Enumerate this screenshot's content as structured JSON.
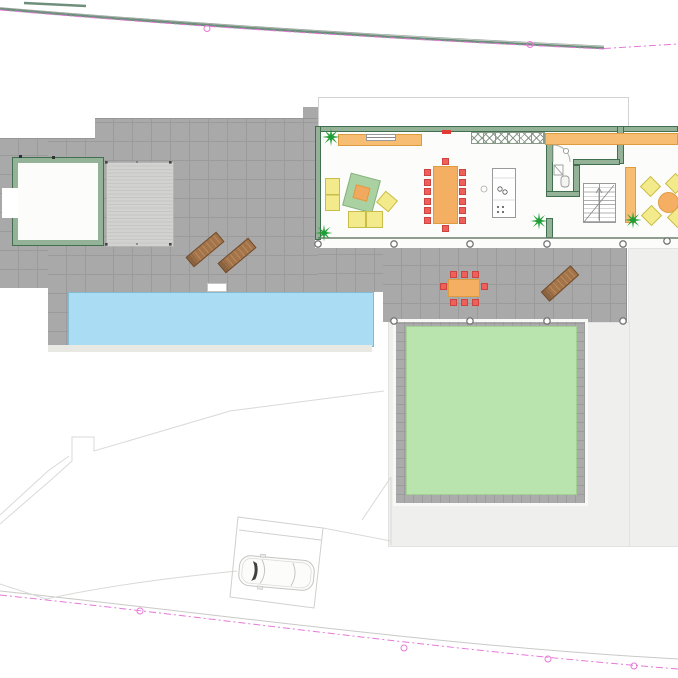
{
  "drawing": {
    "type": "architectural-site-plan",
    "visible_text": [],
    "elements": [
      "property-boundary-north",
      "property-boundary-south",
      "swimming-pool",
      "pool-ladder",
      "stone-terrace",
      "pool-house",
      "wood-deck",
      "residence",
      "roof-outline",
      "living-room",
      "sofa",
      "armchair",
      "rug",
      "coffee-table",
      "sideboard",
      "tv",
      "dining-table",
      "dining-chairs",
      "kitchen-cabinets",
      "kitchen-island",
      "bathroom",
      "staircase",
      "wardrobe",
      "breakfast-table",
      "breakfast-chairs",
      "outdoor-dining-set",
      "sun-loungers",
      "palm-plants",
      "pergola-columns",
      "lawn",
      "paver-border",
      "footpath",
      "parking-spot",
      "car"
    ]
  },
  "colors": {
    "terrace-fill": "#a9a9a9",
    "terrace-line": "#9b9b9b",
    "paver-fill": "#ababab",
    "paver-line": "#9c9c9c",
    "deck-fill": "#d2d2d0",
    "deck-line": "#c6c6c4",
    "pool-fill": "#aadcf4",
    "pool-border": "#84b9d2",
    "pool-edge": "#e9e9e3",
    "lawn-fill": "#bae4ae",
    "lawn-border": "#a3d193",
    "lightgray-fill": "#efefed",
    "lightgray-border": "#e2e2e0",
    "wall-fill": "#93b297",
    "wall-border": "#426f50",
    "floor-white": "#fcfcfb",
    "roof-border": "#d2d2d0",
    "orange-fill": "#f7bd73",
    "orange-border": "#df9b40",
    "yellow-fill": "#f3ea8c",
    "yellow-border": "#c9bd4a",
    "rug-fill": "#a9d1a1",
    "rug-border": "#86b17d",
    "coffee-fill": "#f0a95f",
    "red-fill": "#ee6059",
    "red-border": "#cc4340",
    "table-orange": "#f5af63",
    "lounger-fill": "#a3744a",
    "lounger-line": "#b98a5c",
    "lounger-border": "#6f4c2d",
    "palm-green": "#1f9e36",
    "boundary-green": "#6f8f7d",
    "boundary-gray": "#9aa59d",
    "pink": "#e678d8",
    "faint-line": "#d9d9d7",
    "parking-line": "#cfcfcd",
    "car-line": "#c5c5c3",
    "car-dark": "#404040",
    "column-stroke": "#777777",
    "glass-line": "#6b7f6b",
    "hatch-line": "#8a9a8a",
    "stair-line": "#b0b0b0",
    "detail-gray": "#999999",
    "red-marker": "#e23b33"
  }
}
